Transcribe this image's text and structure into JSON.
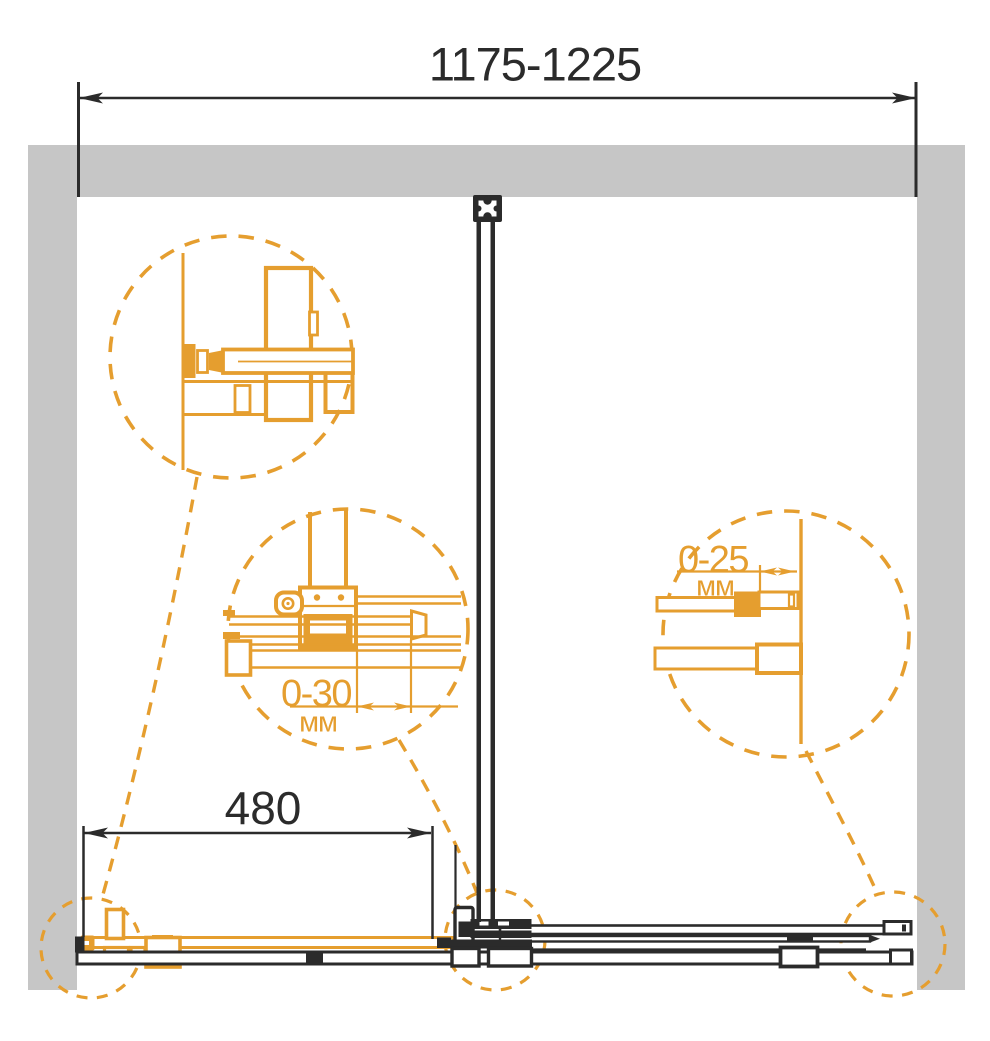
{
  "diagram": {
    "kind": "shower-enclosure-installation-top-view",
    "overall_width_mm": "1175-1225",
    "door_width_mm": "480",
    "center_adjustment": {
      "range": "0-30",
      "unit": "мм"
    },
    "wall_adjustment": {
      "range": "0-25",
      "unit": "мм"
    },
    "colors": {
      "accent_orange": "#E59E2F",
      "line_black": "#2B2B2B",
      "wall_gray": "#C6C6C6",
      "background": "#FFFFFF"
    }
  }
}
